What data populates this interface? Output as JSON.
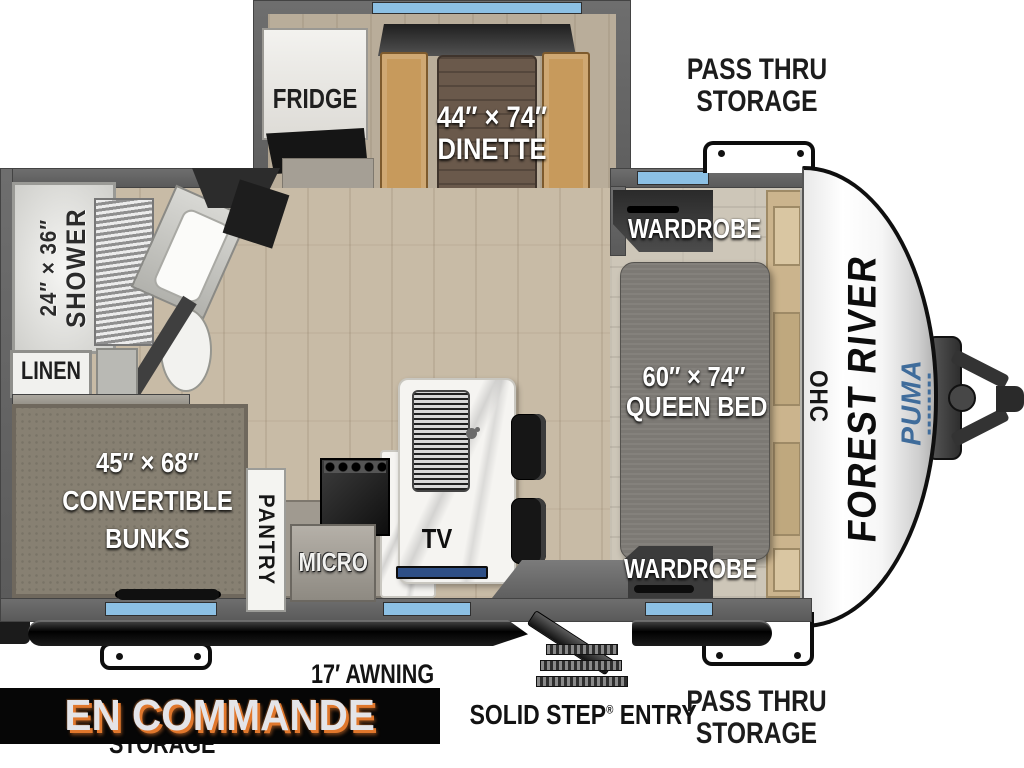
{
  "banner": {
    "label": "EN COMMANDE"
  },
  "plan": {
    "fridge": "FRIDGE",
    "dinette": {
      "line1": "44″ × 74″",
      "line2": "DINETTE"
    },
    "pass_thru_top": {
      "line1": "PASS THRU",
      "line2": "STORAGE"
    },
    "wardrobe_top": "WARDROBE",
    "queen_bed": {
      "line1": "60″ × 74″",
      "line2": "QUEEN BED"
    },
    "wardrobe_bottom": "WARDROBE",
    "ohc": "OHC",
    "shower": {
      "line1": "24″ × 36″",
      "line2": "SHOWER"
    },
    "linen": "LINEN",
    "bunks": {
      "line1": "45″ × 68″",
      "line2": "CONVERTIBLE",
      "line3": "BUNKS"
    },
    "pantry": "PANTRY",
    "micro": "MICRO",
    "tv": "TV",
    "awning": "17′ AWNING",
    "solid_step": {
      "before": "SOLID STEP",
      "reg": "®",
      "after": " ENTRY"
    },
    "pass_thru_bottom": {
      "line1": "PASS THRU",
      "line2": "STORAGE"
    },
    "storage_partial": "STORAGE",
    "brand": {
      "manufacturer": "FOREST RIVER",
      "model": "PUMA"
    }
  },
  "colors": {
    "window_blue": "#8cc0e4",
    "banner_bg": "#060606",
    "banner_text": "#e4e4e8",
    "banner_accent": "#e0772c",
    "puma_blue": "#3f6c9b",
    "bench_tan": "#c79a5c",
    "wall_gray": "#5f5f5f"
  }
}
